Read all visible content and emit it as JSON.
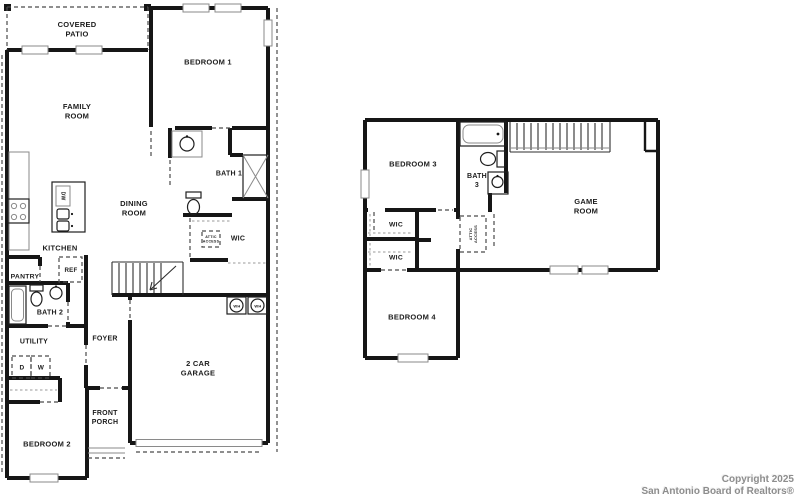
{
  "document": {
    "kind": "real-estate floor plan",
    "floors": 2
  },
  "colors": {
    "wall": "#161616",
    "thin_line": "#8a8a8a",
    "dash_line": "#4a4a4a",
    "label_text": "#1c1c1c",
    "copyright_text": "#8d8d8d",
    "background": "#ffffff"
  },
  "copyright": {
    "line1": "Copyright 2025",
    "line2": "San Antonio Board of Realtors®"
  },
  "floor1_rooms": [
    "COVERED PATIO",
    "FAMILY ROOM",
    "BEDROOM 1",
    "BATH 1",
    "DINING ROOM",
    "KITCHEN",
    "WIC",
    "PANTRY",
    "BATH 2",
    "UTILITY",
    "FOYER",
    "BEDROOM 2",
    "FRONT PORCH",
    "2 CAR GARAGE"
  ],
  "floor2_rooms": [
    "BEDROOM 3",
    "BATH 3",
    "GAME ROOM",
    "WIC",
    "WIC",
    "BEDROOM 4"
  ],
  "appliance_tags": [
    "DW",
    "REF",
    "D",
    "W",
    "WH",
    "WH",
    "ATTIC ACCESS",
    "ATTIC ACCESS"
  ],
  "labels": [
    {
      "id": "label-covered-patio",
      "x": 77,
      "y": 29,
      "size": 7.5,
      "lines": [
        "COVERED",
        "PATIO"
      ]
    },
    {
      "id": "label-family-room",
      "x": 77,
      "y": 111,
      "size": 7.5,
      "lines": [
        "FAMILY",
        "ROOM"
      ]
    },
    {
      "id": "label-bedroom-1",
      "x": 208,
      "y": 62,
      "size": 7.5,
      "lines": [
        "BEDROOM 1"
      ]
    },
    {
      "id": "label-bath-1",
      "x": 229,
      "y": 173,
      "size": 7,
      "lines": [
        "BATH 1"
      ]
    },
    {
      "id": "label-dining-room",
      "x": 134,
      "y": 208,
      "size": 7.5,
      "lines": [
        "DINING",
        "ROOM"
      ]
    },
    {
      "id": "label-kitchen",
      "x": 60,
      "y": 248,
      "size": 7.5,
      "lines": [
        "KITCHEN"
      ]
    },
    {
      "id": "label-wic-floor1",
      "x": 238,
      "y": 238,
      "size": 7,
      "lines": [
        "WIC"
      ]
    },
    {
      "id": "label-attic-access-floor1",
      "x": 211,
      "y": 239,
      "size": 3.6,
      "lines": [
        "ATTIC",
        "ACCESS"
      ]
    },
    {
      "id": "label-pantry",
      "x": 25,
      "y": 276,
      "size": 6.8,
      "lines": [
        "PANTRY"
      ]
    },
    {
      "id": "label-ref",
      "x": 71,
      "y": 270,
      "size": 6.2,
      "lines": [
        "REF"
      ]
    },
    {
      "id": "label-bath-2",
      "x": 50,
      "y": 312,
      "size": 7,
      "lines": [
        "BATH 2"
      ]
    },
    {
      "id": "label-utility",
      "x": 34,
      "y": 341,
      "size": 7,
      "lines": [
        "UTILITY"
      ]
    },
    {
      "id": "label-dryer",
      "x": 22,
      "y": 367,
      "size": 6.5,
      "lines": [
        "D"
      ]
    },
    {
      "id": "label-washer",
      "x": 41,
      "y": 367,
      "size": 6.5,
      "lines": [
        "W"
      ]
    },
    {
      "id": "label-foyer",
      "x": 105,
      "y": 338,
      "size": 7,
      "lines": [
        "FOYER"
      ]
    },
    {
      "id": "label-bedroom-2",
      "x": 47,
      "y": 444,
      "size": 7.5,
      "lines": [
        "BEDROOM 2"
      ]
    },
    {
      "id": "label-front-porch",
      "x": 105,
      "y": 417,
      "size": 7,
      "lines": [
        "FRONT",
        "PORCH"
      ]
    },
    {
      "id": "label-garage",
      "x": 198,
      "y": 368,
      "size": 7.5,
      "lines": [
        "2 CAR",
        "GARAGE"
      ]
    },
    {
      "id": "label-water-heater-1",
      "x": 237,
      "y": 306,
      "size": 4,
      "lines": [
        "WH"
      ]
    },
    {
      "id": "label-water-heater-2",
      "x": 258,
      "y": 306,
      "size": 4,
      "lines": [
        "WH"
      ]
    },
    {
      "id": "label-dishwasher",
      "x": 63,
      "y": 196,
      "size": 5,
      "rot": 90,
      "lines": [
        "DW"
      ]
    },
    {
      "id": "label-bedroom-3",
      "x": 413,
      "y": 164,
      "size": 7.5,
      "lines": [
        "BEDROOM 3"
      ]
    },
    {
      "id": "label-bath-3",
      "x": 477,
      "y": 180,
      "size": 7,
      "lines": [
        "BATH",
        "3"
      ]
    },
    {
      "id": "label-game-room",
      "x": 586,
      "y": 206,
      "size": 7.5,
      "lines": [
        "GAME",
        "ROOM"
      ]
    },
    {
      "id": "label-wic-floor2-a",
      "x": 396,
      "y": 224,
      "size": 6.8,
      "lines": [
        "WIC"
      ]
    },
    {
      "id": "label-wic-floor2-b",
      "x": 396,
      "y": 257,
      "size": 6.8,
      "lines": [
        "WIC"
      ]
    },
    {
      "id": "label-attic-access-floor2",
      "x": 473,
      "y": 234,
      "size": 4,
      "rot": -90,
      "lines": [
        "ATTIC",
        "ACCESS"
      ]
    },
    {
      "id": "label-bedroom-4",
      "x": 412,
      "y": 317,
      "size": 7.5,
      "lines": [
        "BEDROOM 4"
      ]
    }
  ]
}
